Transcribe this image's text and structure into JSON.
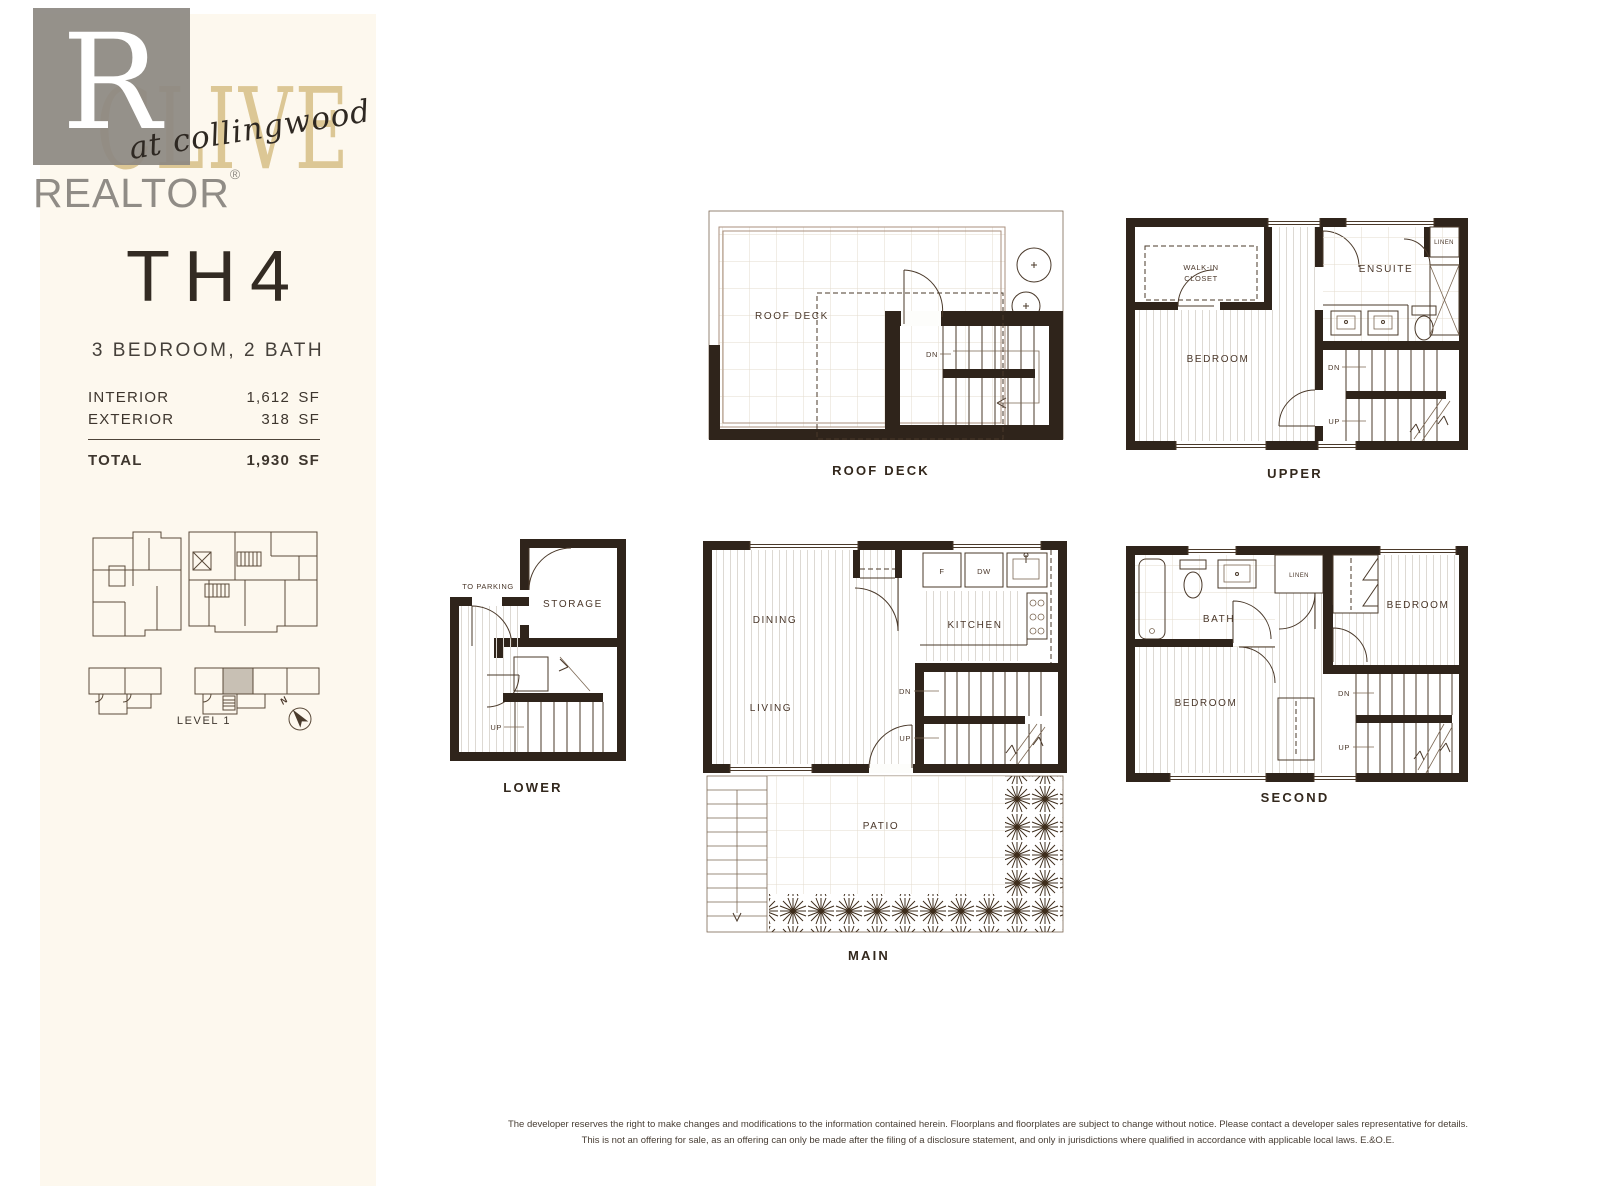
{
  "colors": {
    "panel": "#FDF8EE",
    "ink": "#2F241B",
    "gold": "#DCC795",
    "logo_gray": "#8C8882",
    "keyplan_highlight": "#C8C0B4"
  },
  "watermark": {
    "letter": "R",
    "label": "REALTOR",
    "registered": "®"
  },
  "brand": {
    "name": "CLIVE",
    "tagline": "at collingwood"
  },
  "unit": {
    "name": "TH4",
    "subtitle": "3 BEDROOM, 2 BATH",
    "areas": [
      {
        "label": "INTERIOR",
        "value": "1,612",
        "unit": "SF"
      },
      {
        "label": "EXTERIOR",
        "value": "318",
        "unit": "SF"
      }
    ],
    "total": {
      "label": "TOTAL",
      "value": "1,930",
      "unit": "SF"
    }
  },
  "keyplan": {
    "level": "LEVEL 1",
    "north": "N"
  },
  "plans": {
    "roof_deck": {
      "caption": "ROOF DECK",
      "room": "ROOF DECK",
      "dn": "DN"
    },
    "upper": {
      "caption": "UPPER",
      "walkin_1": "WALK-IN",
      "walkin_2": "CLOSET",
      "bedroom": "BEDROOM",
      "ensuite": "ENSUITE",
      "linen": "LINEN",
      "dn": "DN",
      "up": "UP"
    },
    "lower": {
      "caption": "LOWER",
      "storage": "STORAGE",
      "to_parking": "TO PARKING",
      "up": "UP"
    },
    "main": {
      "caption": "MAIN",
      "dining": "DINING",
      "living": "LIVING",
      "kitchen": "KITCHEN",
      "patio": "PATIO",
      "fridge": "F",
      "dishwasher": "DW",
      "dn": "DN",
      "up": "UP"
    },
    "second": {
      "caption": "SECOND",
      "bath": "BATH",
      "linen": "LINEN",
      "bedroom_a": "BEDROOM",
      "bedroom_b": "BEDROOM",
      "dn": "DN",
      "up": "UP"
    }
  },
  "footer": {
    "line1": "The developer reserves the right to make changes and modifications to the information contained herein. Floorplans and floorplates are subject to change without notice. Please contact a developer sales representative for details.",
    "line2": "This is not an offering for sale, as an offering can only be made after the filing of a disclosure statement, and only in jurisdictions where qualified in accordance with applicable local laws. E.&O.E."
  }
}
